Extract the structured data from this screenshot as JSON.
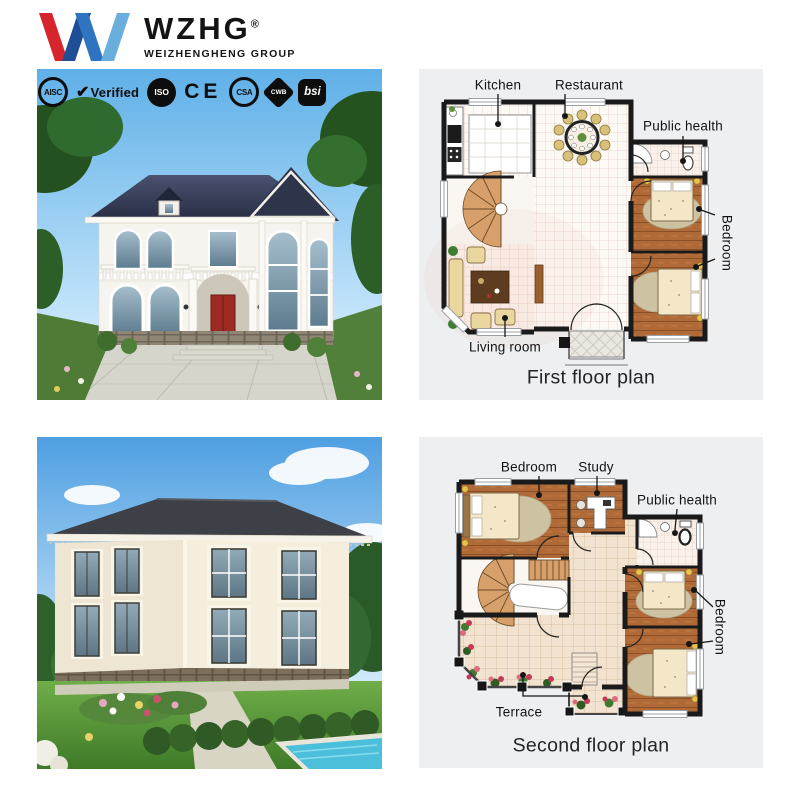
{
  "brand": {
    "name": "WZHG",
    "reg": "®",
    "group": "WEIZHENGHENG GROUP"
  },
  "badges": [
    {
      "id": "aisc",
      "label": "AISC"
    },
    {
      "id": "verified",
      "label": "Verified",
      "check": "✔"
    },
    {
      "id": "iso",
      "label": "ISO"
    },
    {
      "id": "ce",
      "label": "CE"
    },
    {
      "id": "csa",
      "label": "CSA"
    },
    {
      "id": "cwb",
      "label": "CWB"
    },
    {
      "id": "bsi",
      "label": "bsi"
    }
  ],
  "plans": {
    "first": {
      "caption": "First floor plan",
      "labels": {
        "kitchen": "Kitchen",
        "restaurant": "Restaurant",
        "public_health": "Public health",
        "bedroom": "Bedroom",
        "living_room": "Living room"
      }
    },
    "second": {
      "caption": "Second floor plan",
      "labels": {
        "bedroom": "Bedroom",
        "study": "Study",
        "public_health": "Public health",
        "bedroom_right": "Bedroom",
        "terrace": "Terrace"
      }
    }
  },
  "colors": {
    "logo_red": "#d6252d",
    "logo_navy": "#1e4e95",
    "logo_blue": "#2f74c0",
    "logo_lightblue": "#6aaede",
    "panel_bg": "#edeff1",
    "wall": "#1a1a1a",
    "wood_floor": "#b06a38",
    "label_text": "#131313"
  }
}
